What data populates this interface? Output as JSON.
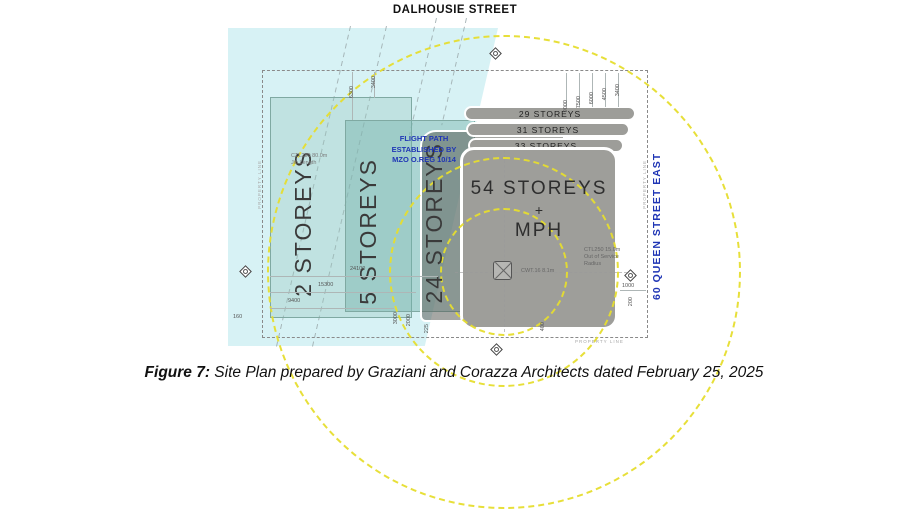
{
  "figure": {
    "streets": {
      "top": "DALHOUSIE STREET",
      "right": "60 QUEEN STREET EAST"
    },
    "flight_path_note": {
      "line1": "FLIGHT PATH",
      "line2": "ESTABLISHED BY",
      "line3": "MZO O.REG 10/14"
    },
    "blocks": {
      "b2": "2 STOREYS",
      "b5": "5 STOREYS",
      "b24": "24 STOREYS",
      "band29": "29 STOREYS",
      "band31": "31 STOREYS",
      "band33": "33 STOREYS",
      "tower_line1": "54 STOREYS",
      "tower_plus": "+",
      "tower_line2": "MPH"
    },
    "annotations": {
      "jib_line1": "CTL280 80.0m",
      "jib_line2": "Jib Length",
      "oos_line1": "CTL250 15.0m",
      "oos_line2": "Out of Service",
      "oos_line3": "Radius",
      "cwt": "CWT.16 8.1m",
      "property_line": "PROPERTY LINE"
    },
    "dimensions": {
      "d6300": "6300",
      "d3400a": "3400",
      "d9000": "9000",
      "d7500": "7500",
      "d6000": "6000",
      "d4500": "4500",
      "d3400b": "3400",
      "d24100": "24100",
      "d15300": "15300",
      "d9400": "9400",
      "d160": "160",
      "d3000": "3000",
      "d2000": "2000",
      "d225": "225",
      "d400": "400",
      "d1000": "1000",
      "d200": "200"
    },
    "colors": {
      "flight_band": "#d7f2f5",
      "crane_radius_yellow": "#e6de2f",
      "note_blue": "#1f35b5",
      "tower_grey": "#9e9e9a"
    }
  },
  "caption": {
    "label": "Figure 7:",
    "text": " Site Plan prepared by Graziani and Corazza Architects dated February 25, 2025"
  }
}
